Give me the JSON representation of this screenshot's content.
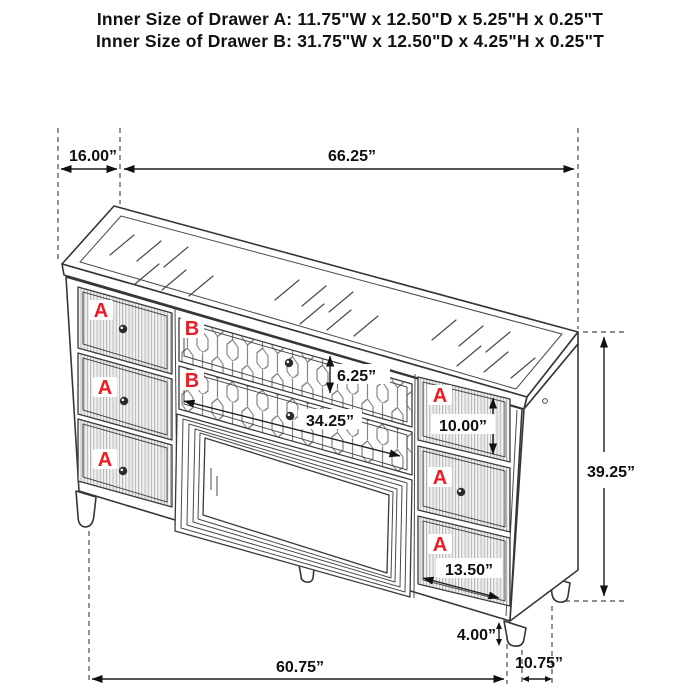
{
  "header": {
    "line1": "Inner Size of Drawer A: 11.75\"W x 12.50\"D x 5.25\"H x 0.25\"T",
    "line2": "Inner Size of Drawer B: 31.75\"W x 12.50\"D x 4.25\"H x 0.25\"T"
  },
  "dimensions": {
    "top_depth": "16.00”",
    "top_width": "66.25”",
    "drawer_b_height": "6.25”",
    "drawer_b_width": "34.25”",
    "right_top_drawer_height": "10.00”",
    "right_drawer_width": "13.50”",
    "cabinet_height": "39.25”",
    "leg_height": "4.00”",
    "front_width": "60.75”",
    "side_depth": "10.75”"
  },
  "drawer_labels": {
    "a": "A",
    "b": "B"
  },
  "colors": {
    "label_red": "#ed1c24",
    "line_dark": "#363636",
    "dimension_text": "#0f0f0f",
    "background": "#ffffff"
  }
}
